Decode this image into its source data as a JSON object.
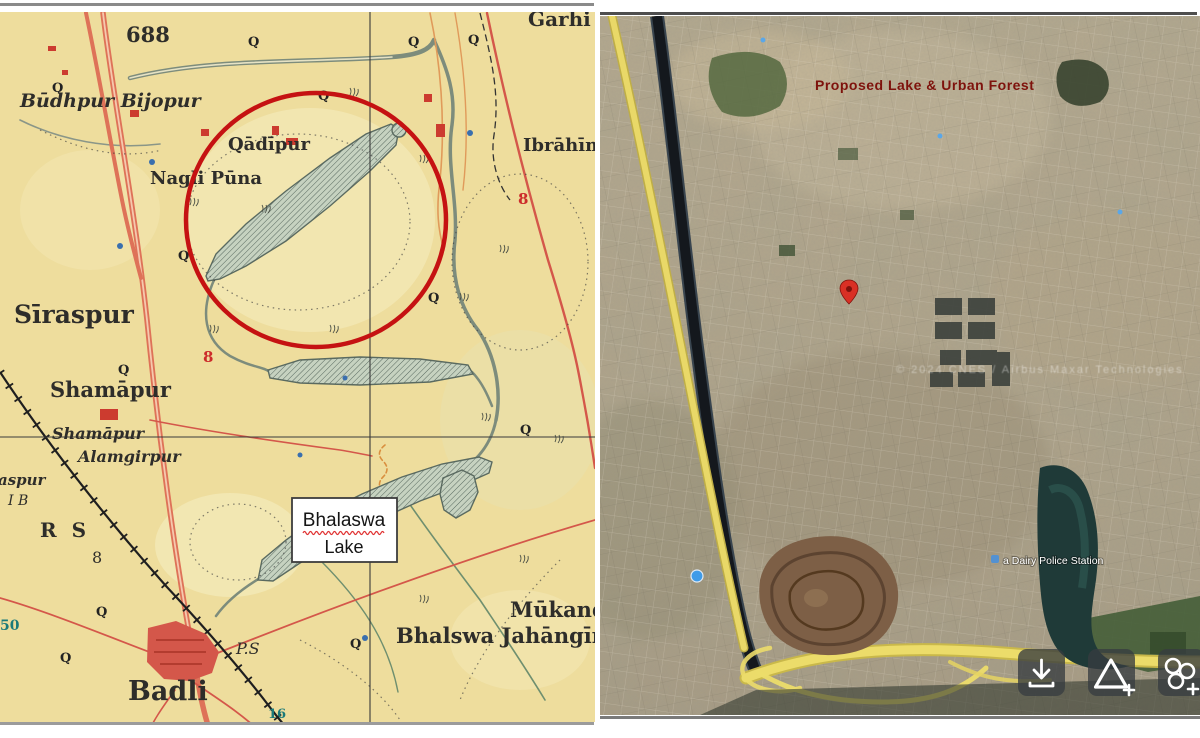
{
  "figure": {
    "description_left": "historical survey map",
    "description_right": "satellite imagery"
  },
  "left_map": {
    "bg": "#eedd9d",
    "highlight_circle_color": "#c51212",
    "well_symbol": "Q",
    "label_box": {
      "line1": "Bhalaswa",
      "line2": "Lake"
    },
    "labels": [
      {
        "text": "688"
      },
      {
        "text": "Garhi"
      },
      {
        "text": "Būdhpur Bijopur"
      },
      {
        "text": "Qādīpur"
      },
      {
        "text": "Nagli Pūna"
      },
      {
        "text": "Ibrāhīm"
      },
      {
        "text": "Sīraspur"
      },
      {
        "text": "Shamāpur"
      },
      {
        "text": "Shamāpur"
      },
      {
        "text": "Alamgirpur"
      },
      {
        "text": "aspur"
      },
      {
        "text": "I B"
      },
      {
        "text": "R S"
      },
      {
        "text": "8"
      },
      {
        "text": "P.S"
      },
      {
        "text": "Badli"
      },
      {
        "text": "Mūkandp"
      },
      {
        "text": "Bhalswa Jahāngīrp"
      },
      {
        "text": "8"
      },
      {
        "text": "8"
      },
      {
        "text": "50"
      },
      {
        "text": "16"
      }
    ]
  },
  "right_map": {
    "overlay_title": "Proposed Lake & Urban Forest",
    "overlay_title_color": "#7e120c",
    "police_station_label": "a Dairy Police Station",
    "watermark_text": "© 2024 CNES / Airbus  Maxar Technologies",
    "toolbar": {
      "buttons": [
        {
          "icon": "download-icon"
        },
        {
          "icon": "add-area-icon"
        },
        {
          "icon": "projects-clover-icon"
        }
      ]
    }
  }
}
